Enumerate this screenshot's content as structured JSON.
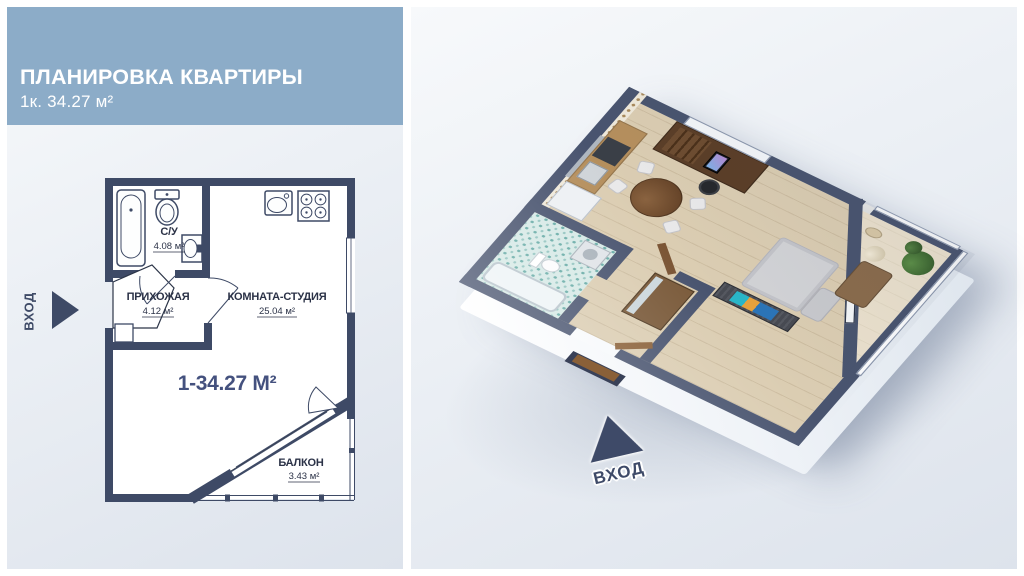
{
  "header": {
    "title": "ПЛАНИРОВКА КВАРТИРЫ",
    "subtitle": "1к. 34.27 м²"
  },
  "plan": {
    "entrance_label": "ВХОД",
    "total_area_label": "1-34.27 М²",
    "rooms": {
      "bathroom": {
        "name": "С/У",
        "area": "4.08 м²"
      },
      "hallway": {
        "name": "ПРИХОЖАЯ",
        "area": "4.12 м²"
      },
      "studio": {
        "name": "КОМНАТА-СТУДИЯ",
        "area": "25.04 м²"
      },
      "balcony": {
        "name": "БАЛКОН",
        "area": "3.43 м²"
      }
    }
  },
  "render3d": {
    "entrance_label": "ВХОД"
  },
  "colors": {
    "banner_blue": "#8cacc8",
    "wall_navy_2d": "#3e4a66",
    "wall_navy_3d": "#49546f",
    "accent_total_text": "#44517e",
    "panel_background": "#e4e9f0",
    "wood_floor": "#dbcdb2",
    "bathroom_tile": "#d6e9e6"
  }
}
